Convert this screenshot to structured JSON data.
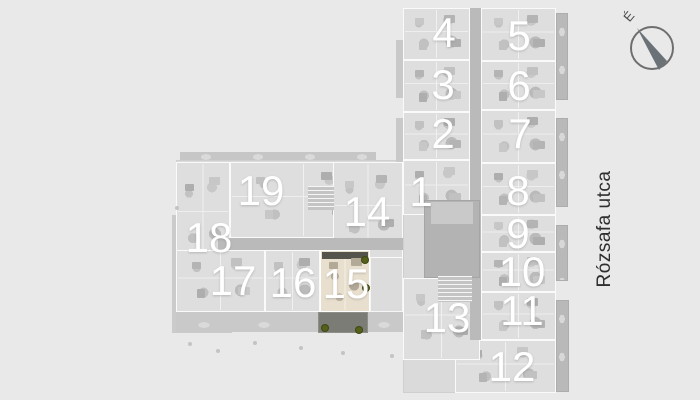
{
  "scene": {
    "type": "apartment-site-plan",
    "street_label": "Rózsafa utca",
    "compass_north_label": "É",
    "highlighted_unit": "15"
  },
  "colors": {
    "background": "#e9e9e9",
    "building_base": "#dadada",
    "unit_fill": "#dedede",
    "unit_highlight_fill": "#e8dfce",
    "corridor": "#bababa",
    "courtyard": "#b3b3b3",
    "balcony": "#b9b9b9",
    "highlight_balcony": "#7a7c75",
    "plant_green": "#55601c",
    "unit_number_color": "#ffffff",
    "street_text_color": "#2e2e2e"
  },
  "units": [
    {
      "label": "19",
      "x": 230,
      "y": 162,
      "w": 147,
      "h": 76,
      "cx": 261,
      "cy": 191
    },
    {
      "label": "18",
      "x": 176,
      "y": 162,
      "w": 54,
      "h": 110,
      "cx": 209,
      "cy": 238
    },
    {
      "label": "14",
      "x": 333,
      "y": 162,
      "w": 70,
      "h": 96,
      "cx": 367,
      "cy": 212
    },
    {
      "label": "17",
      "x": 176,
      "y": 250,
      "w": 89,
      "h": 62,
      "cx": 233,
      "cy": 281
    },
    {
      "label": "16",
      "x": 265,
      "y": 250,
      "w": 55,
      "h": 62,
      "cx": 293,
      "cy": 283
    },
    {
      "label": "15",
      "x": 320,
      "y": 250,
      "w": 50,
      "h": 62,
      "cx": 346,
      "cy": 284,
      "highlighted": true
    },
    {
      "label": "4",
      "x": 403,
      "y": 8,
      "w": 67,
      "h": 52,
      "cx": 444,
      "cy": 33
    },
    {
      "label": "3",
      "x": 403,
      "y": 60,
      "w": 67,
      "h": 52,
      "cx": 443,
      "cy": 85
    },
    {
      "label": "2",
      "x": 403,
      "y": 112,
      "w": 67,
      "h": 48,
      "cx": 443,
      "cy": 134
    },
    {
      "label": "1",
      "x": 403,
      "y": 160,
      "w": 67,
      "h": 55,
      "cx": 421,
      "cy": 192
    },
    {
      "label": "5",
      "x": 481,
      "y": 8,
      "w": 75,
      "h": 53,
      "cx": 519,
      "cy": 36
    },
    {
      "label": "6",
      "x": 481,
      "y": 61,
      "w": 75,
      "h": 49,
      "cx": 519,
      "cy": 86
    },
    {
      "label": "7",
      "x": 481,
      "y": 110,
      "w": 75,
      "h": 53,
      "cx": 520,
      "cy": 134
    },
    {
      "label": "8",
      "x": 481,
      "y": 163,
      "w": 75,
      "h": 52,
      "cx": 518,
      "cy": 191
    },
    {
      "label": "9",
      "x": 481,
      "y": 215,
      "w": 75,
      "h": 37,
      "cx": 518,
      "cy": 234
    },
    {
      "label": "10",
      "x": 481,
      "y": 252,
      "w": 75,
      "h": 40,
      "cx": 522,
      "cy": 272
    },
    {
      "label": "11",
      "x": 481,
      "y": 292,
      "w": 75,
      "h": 48,
      "cx": 522,
      "cy": 311
    },
    {
      "label": "12",
      "x": 455,
      "y": 340,
      "w": 101,
      "h": 53,
      "cx": 512,
      "cy": 367
    },
    {
      "label": "13",
      "x": 403,
      "y": 278,
      "w": 77,
      "h": 82,
      "cx": 447,
      "cy": 318
    }
  ]
}
